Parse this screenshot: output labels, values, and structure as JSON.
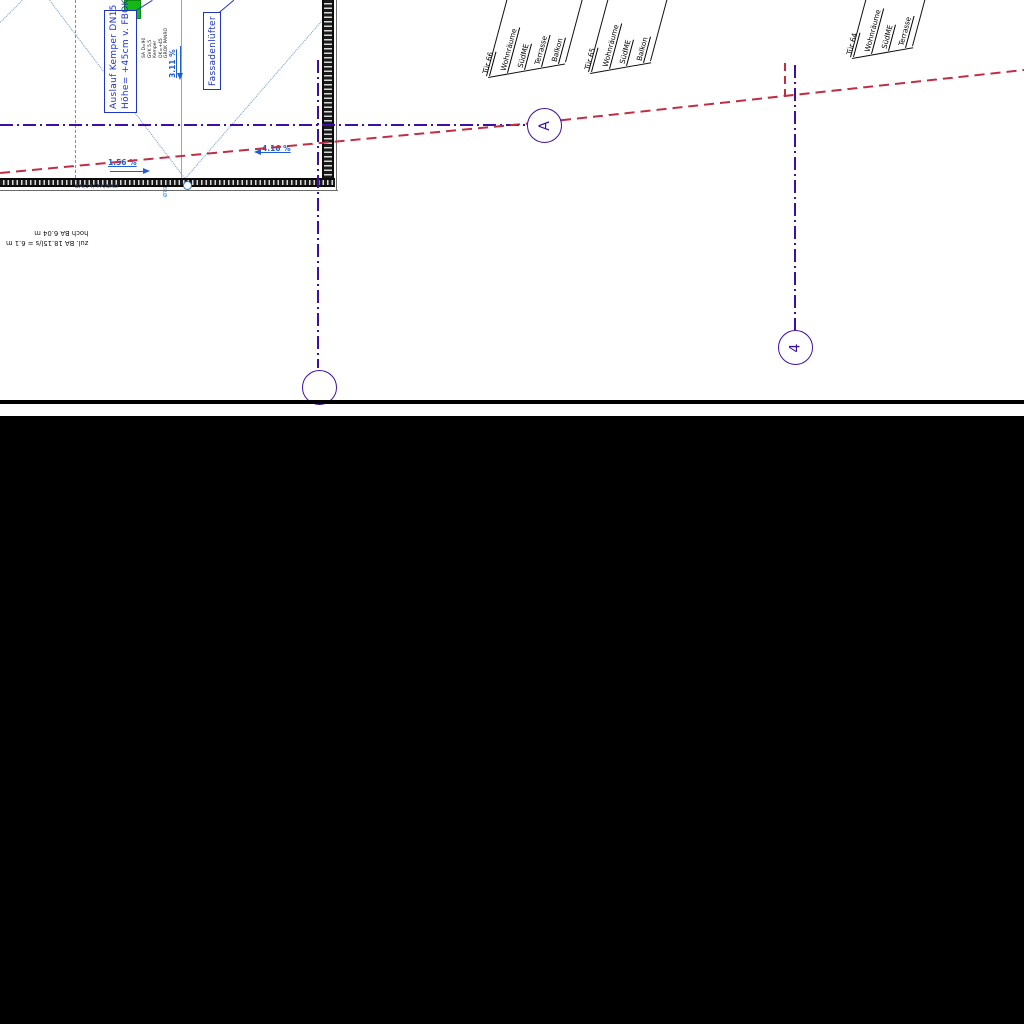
{
  "drawing": {
    "labels": {
      "auslauf_line1": "Auslauf Kemper DN15",
      "auslauf_line2": "Höhe= +45cm v. FBOK",
      "fassadenluefter": "Fassadenlüfter",
      "slope_vertical": "3.11 %",
      "slope_bottom_left": "1.56 %",
      "slope_bottom_right": "4.16 %",
      "edge_note": "BA(14) PA/BRD",
      "gully_note": "Ø70",
      "flipped_line1": "zul. BA 18.15l/s = 6.1 m",
      "flipped_line2": "hoch BA 6.04 m"
    },
    "drain_note_lines": [
      "SA D=90",
      "GVK 5,5",
      "Kemper",
      "OK=+45",
      "GROK PANRO"
    ],
    "grid_markers": {
      "a": "A",
      "four": "4"
    },
    "door_tags": [
      {
        "title": "Tür 66",
        "entries": [
          "Wohnräume",
          "SüdME",
          "Terrasse",
          "Balkon"
        ]
      },
      {
        "title": "Tür 65",
        "entries": [
          "Wohnräume",
          "SüdME",
          "Balkon"
        ]
      },
      {
        "title": "Tür 64",
        "entries": [
          "Wohnräume",
          "SüdME",
          "Terrasse"
        ]
      }
    ],
    "colors": {
      "grid_purple": "#3d0fa6",
      "boundary_red": "#c12e44",
      "label_blue": "#1f35c8",
      "slope_blue": "#1f5fcf",
      "roof_line_blue": "#6b93cf",
      "cyan_dash": "#3fa3dc",
      "drain_green": "#15b915",
      "mask_black": "#000000"
    }
  }
}
